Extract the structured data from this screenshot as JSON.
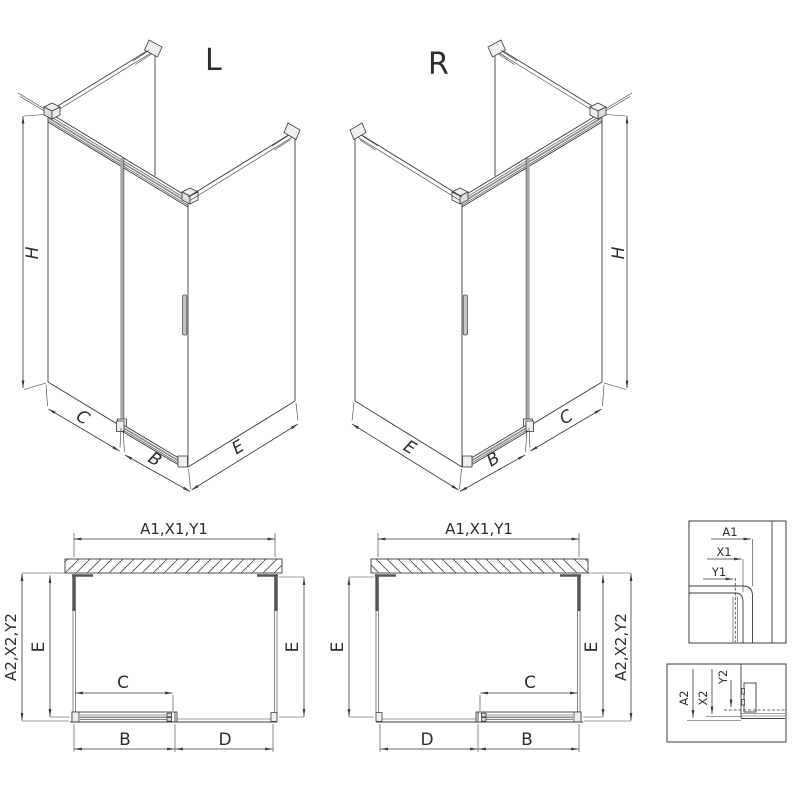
{
  "drawing": {
    "iso_left": {
      "title": "L",
      "dim_h": "H",
      "dim_c": "C",
      "dim_b": "B",
      "dim_e": "E"
    },
    "iso_right": {
      "title": "R",
      "dim_h": "H",
      "dim_c": "C",
      "dim_b": "B",
      "dim_e": "E"
    },
    "plan_left": {
      "dim_top": "A1,X1,Y1",
      "dim_left_outer": "A2,X2,Y2",
      "dim_left_inner": "E",
      "dim_right": "E",
      "dim_opening": "C",
      "dim_bottom_left": "B",
      "dim_bottom_right": "D"
    },
    "plan_right": {
      "dim_top": "A1,X1,Y1",
      "dim_left": "E",
      "dim_right_inner": "E",
      "dim_right_outer": "A2,X2,Y2",
      "dim_opening": "C",
      "dim_bottom_left": "D",
      "dim_bottom_right": "B"
    },
    "detail_wall_profile": {
      "dim_a1": "A1",
      "dim_x1": "X1",
      "dim_y1": "Y1"
    },
    "detail_bottom_rail": {
      "dim_a2": "A2",
      "dim_x2": "X2",
      "dim_y2": "Y2"
    },
    "colors": {
      "line": "#3b3b3b",
      "glass_edge": "#a8a8a8",
      "background": "#ffffff"
    }
  }
}
